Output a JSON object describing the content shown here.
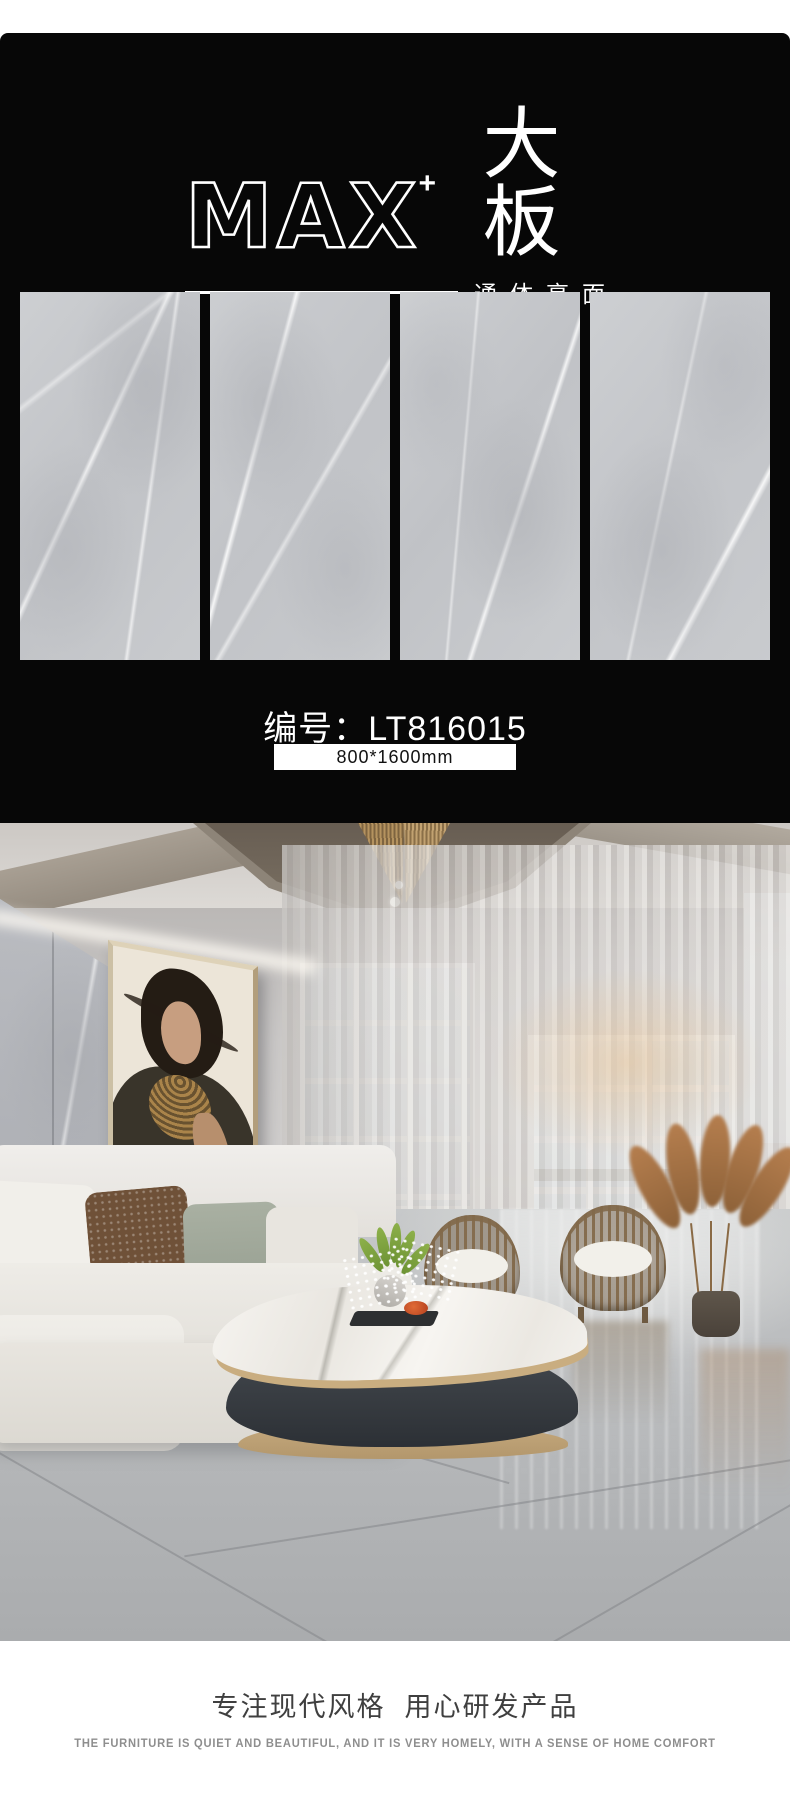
{
  "brand": {
    "logo_text": "MAX",
    "logo_sup": "+",
    "logo_cn": "大板",
    "tagline": "通体亮面"
  },
  "product": {
    "code_label": "编号：",
    "code": "LT816015",
    "size": "800*1600mm"
  },
  "footer": {
    "slogan_cn": "专注现代风格  用心研发产品",
    "slogan_en": "THE FURNITURE IS QUIET AND BEAUTIFUL, AND IT IS VERY HOMELY, WITH A SENSE OF HOME COMFORT"
  },
  "colors": {
    "panel_background": "#070707",
    "tile_gray": "#c6c8cb",
    "accent_gold": "#c9ad80",
    "size_box_background": "#ffffff"
  }
}
